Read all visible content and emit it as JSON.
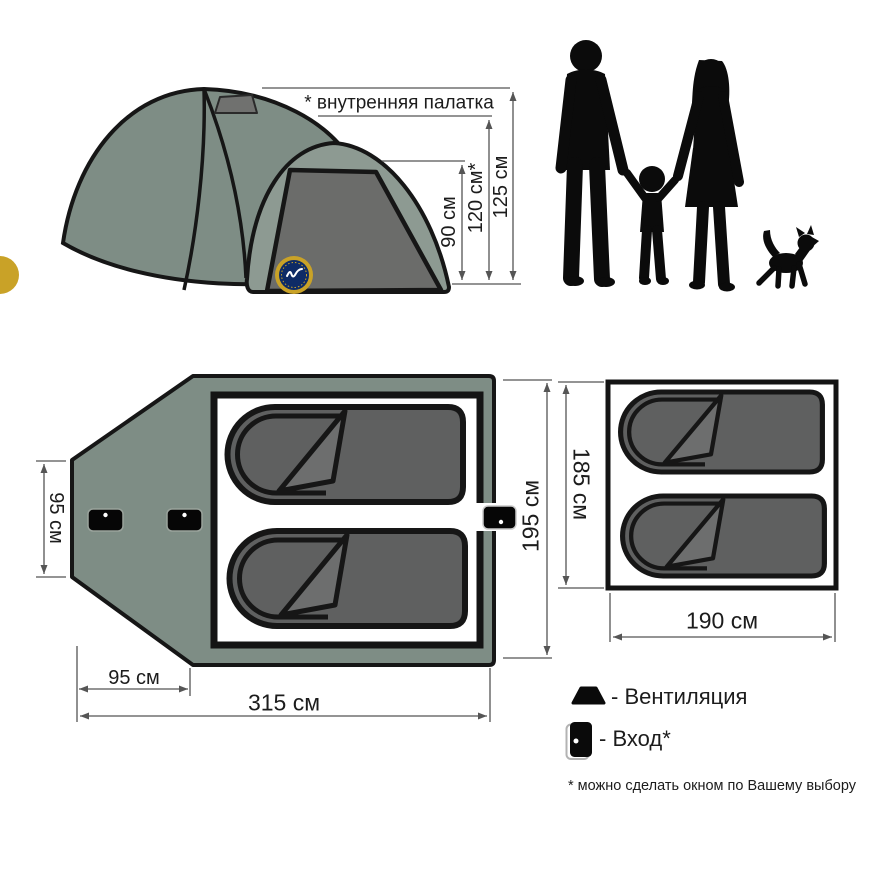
{
  "page": {
    "background": "#ffffff"
  },
  "colors": {
    "tent_fabric": "#7e8d85",
    "front_dome_fabric": "#8d9a92",
    "dark_panel": "#6b6c6a",
    "bag_body": "#5f6060",
    "bag_fold": "#6d6e6e",
    "outline": "#161616",
    "dimension_line": "#555555",
    "logo_ring": "#c9a227",
    "logo_center": "#0e2b66"
  },
  "side_view": {
    "annotation": "* внутренняя палатка",
    "heights": [
      {
        "name": "front-dome-height",
        "label": "90 см"
      },
      {
        "name": "inner-tent-height",
        "label": "120 см*"
      },
      {
        "name": "outer-tent-height",
        "label": "125 см"
      }
    ],
    "logo_icon": "brand-badge-icon",
    "vent_icon": "vent-trapezoid-icon",
    "door_icon": "door-panel-icon"
  },
  "family": {
    "icon": "family-silhouette-icon",
    "members": [
      "man",
      "child",
      "woman",
      "dog"
    ]
  },
  "floor_plan": {
    "vestibule_width_label": "95 см",
    "tent_width_label": "195 см",
    "vestibule_depth_label": "95 см",
    "total_length_label": "315 см",
    "entrance_icon": "door-icon",
    "sleeping_bag_icon": "sleeping-bag-icon",
    "entrance_count": 3,
    "sleeping_bag_count": 2
  },
  "inner_plan": {
    "width_label": "185 см",
    "length_label": "190 см",
    "sleeping_bag_count": 2
  },
  "legend": {
    "ventilation_label": "- Вентиляция",
    "ventilation_icon": "vent-trapezoid-icon",
    "entrance_label": "- Вход*",
    "entrance_icon": "door-icon",
    "footnote": "* можно сделать окном по Вашему выбору"
  }
}
